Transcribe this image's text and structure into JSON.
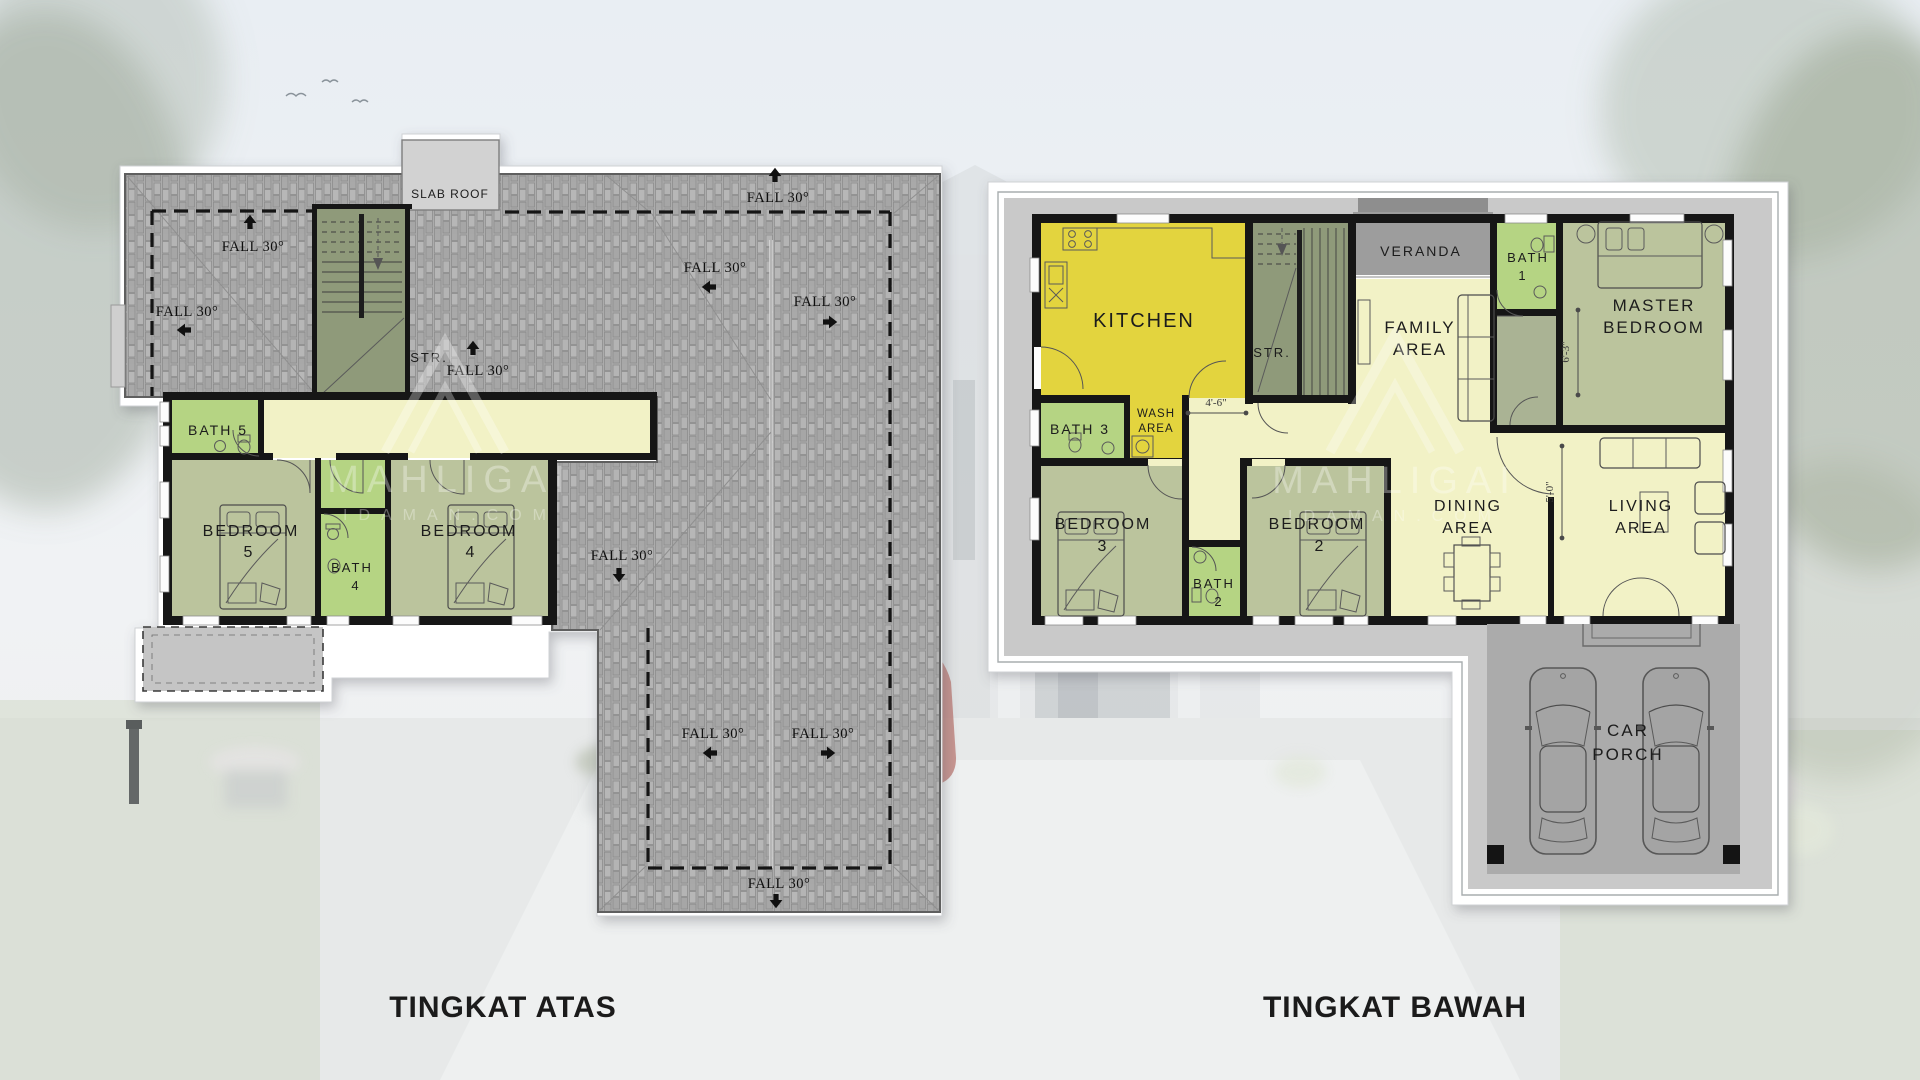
{
  "colors": {
    "kitchen_yellow": "#e3d43e",
    "bath_green": "#b5d483",
    "room_sage": "#bbc49d",
    "hall_cream": "#f2f2c6",
    "stairs_green": "#8f9a7a",
    "veranda_gray": "#9d9d9d",
    "utility_sage": "#aab394",
    "apron_gray": "#c9c9c9",
    "porch_gray": "#ababab",
    "terrace_gray": "#c5c5c5",
    "slab_gray": "#d2d2d2",
    "roof_gray": "#acacac"
  },
  "titles": {
    "upper": "TINGKAT ATAS",
    "lower": "TINGKAT BAWAH"
  },
  "watermark": {
    "brand": "MAHLIGAI",
    "domain": "IDAMAN.COM"
  },
  "upper_plan": {
    "slab_roof": "SLAB ROOF",
    "stairs": "STR.",
    "fall": "FALL 30°",
    "rooms": {
      "bath5": {
        "label": "BATH 5"
      },
      "bedroom5": {
        "line1": "BEDROOM",
        "line2": "5"
      },
      "bath4": {
        "line1": "BATH",
        "line2": "4"
      },
      "bedroom4": {
        "line1": "BEDROOM",
        "line2": "4"
      }
    }
  },
  "lower_plan": {
    "stairs": "STR.",
    "rooms": {
      "kitchen": {
        "label": "KITCHEN"
      },
      "veranda": {
        "label": "VERANDA"
      },
      "bath1": {
        "line1": "BATH",
        "line2": "1"
      },
      "master": {
        "line1": "MASTER",
        "line2": "BEDROOM"
      },
      "family": {
        "line1": "FAMILY",
        "line2": "AREA"
      },
      "bath3": {
        "label": "BATH 3"
      },
      "wash": {
        "line1": "WASH",
        "line2": "AREA"
      },
      "bedroom3": {
        "line1": "BEDROOM",
        "line2": "3"
      },
      "bath2": {
        "line1": "BATH",
        "line2": "2"
      },
      "bedroom2": {
        "line1": "BEDROOM",
        "line2": "2"
      },
      "dining": {
        "line1": "DINING",
        "line2": "AREA"
      },
      "living": {
        "line1": "LIVING",
        "line2": "AREA"
      },
      "carporch": {
        "line1": "CAR",
        "line2": "PORCH"
      }
    },
    "dimensions": {
      "hall": "4'-6\"",
      "master": "6'-3\"",
      "living": "5'-0\""
    }
  }
}
